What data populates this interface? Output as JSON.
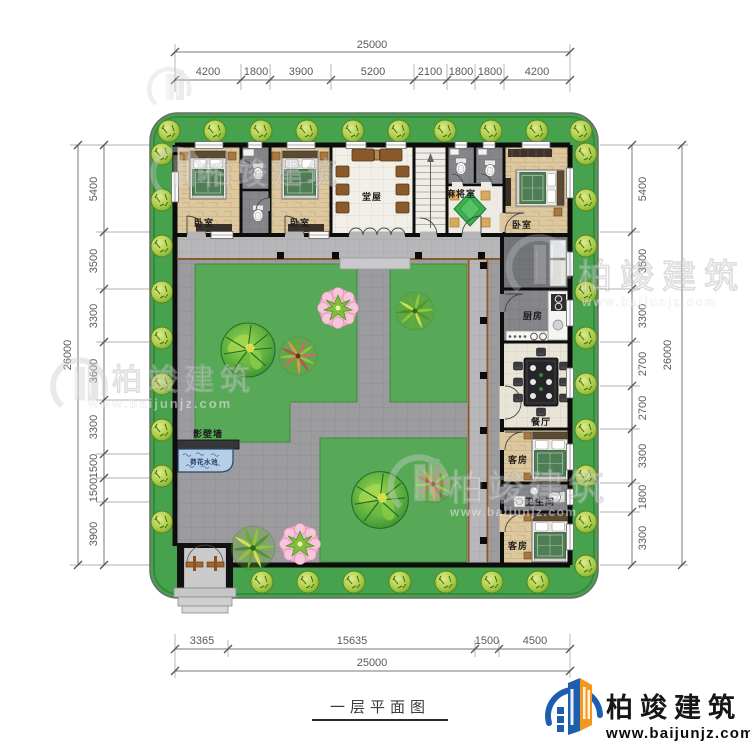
{
  "title": "一层平面图",
  "brand": {
    "name": "柏竣建筑",
    "url": "www.baijunjz.com"
  },
  "watermark": {
    "name": "柏竣建筑",
    "url": "www.baijunjz.com"
  },
  "dimensions": {
    "top": {
      "total": "25000",
      "segments": [
        "4200",
        "1800",
        "3900",
        "5200",
        "2100",
        "1800",
        "1800",
        "4200"
      ]
    },
    "bottom": {
      "total": "25000",
      "segments": [
        "3365",
        "15635",
        "1500",
        "4500"
      ]
    },
    "left": {
      "total": "26000",
      "segments": [
        "5400",
        "3500",
        "3300",
        "3600",
        "3300",
        "1500",
        "1500",
        "3900"
      ]
    },
    "right": {
      "total": "26000",
      "segments": [
        "5400",
        "3500",
        "3300",
        "2700",
        "2700",
        "3300",
        "1800",
        "3300"
      ]
    }
  },
  "rooms": {
    "bedroom": "卧室",
    "hall": "堂屋",
    "mahjong": "麻将室",
    "kitchen": "厨房",
    "dining": "餐厅",
    "guest": "客房",
    "bathroom": "卫生间",
    "screen_wall": "影壁墙",
    "lotus_pond": "荷花水池"
  },
  "colors": {
    "belt_green": "#46a24c",
    "lawn_green": "#57a957",
    "path_gray": "#9c9c9f",
    "wall_black": "#0d0d0d",
    "pond_blue": "#b7cfe6",
    "accent_blue": "#1d5fae",
    "accent_orange": "#f2981d"
  }
}
